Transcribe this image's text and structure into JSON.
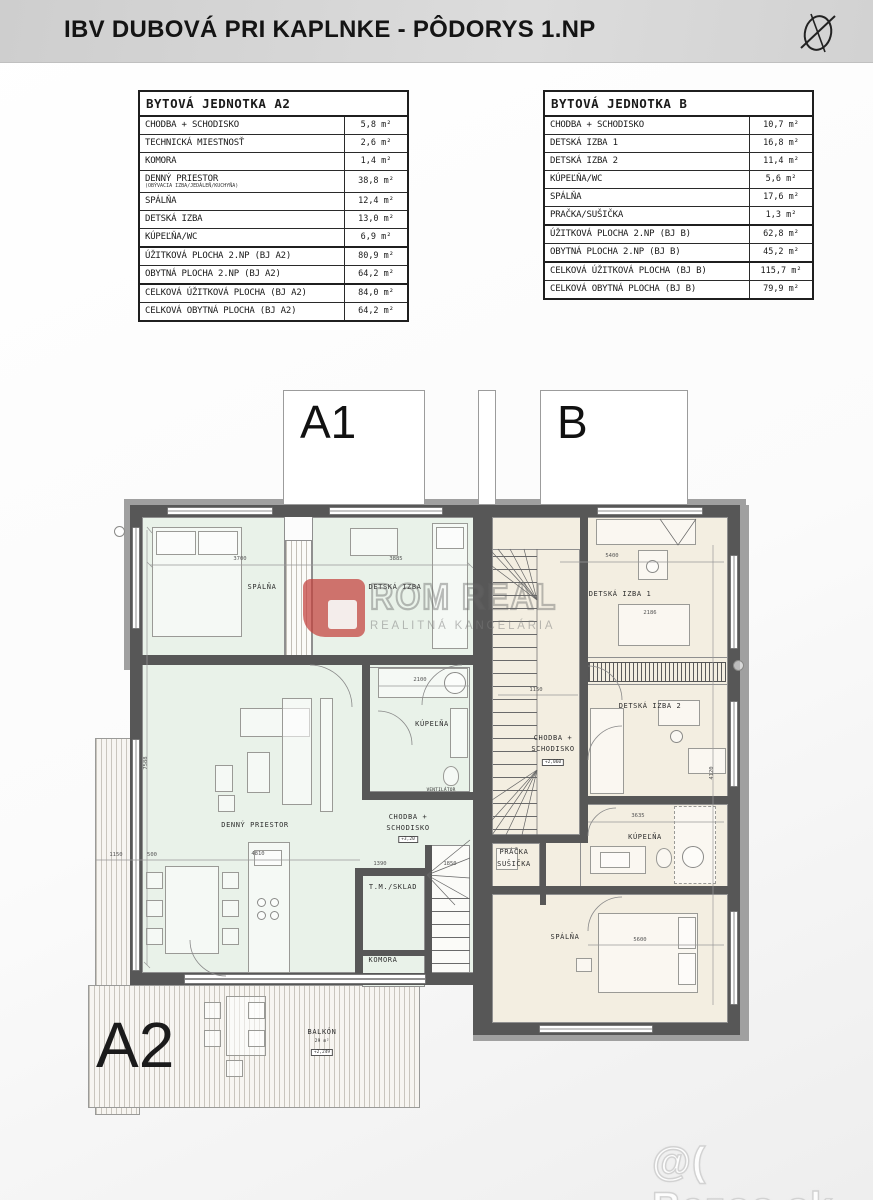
{
  "header": {
    "title": "IBV DUBOVÁ PRI KAPLNKE - PÔDORYS 1.NP",
    "compass_icon": "north-compass"
  },
  "tables": [
    {
      "id": "a2",
      "title": "BYTOVÁ JEDNOTKA A2",
      "rows": [
        {
          "label": "CHODBA + SCHODISKO",
          "value": "5,8 m²"
        },
        {
          "label": "TECHNICKÁ MIESTNOSŤ",
          "value": "2,6 m²"
        },
        {
          "label": "KOMORA",
          "value": "1,4 m²"
        },
        {
          "label": "DENNÝ PRIESTOR",
          "sub": "(OBÝVACIA IZBA/JEDÁLEŇ/KUCHYŇA)",
          "value": "38,8 m²"
        },
        {
          "label": "SPÁLŇA",
          "value": "12,4 m²"
        },
        {
          "label": "DETSKÁ IZBA",
          "value": "13,0 m²"
        },
        {
          "label": "KÚPEĽŇA/WC",
          "value": "6,9 m²"
        }
      ],
      "summary": [
        {
          "label": "ÚŽITKOVÁ PLOCHA 2.NP (BJ A2)",
          "value": "80,9 m²"
        },
        {
          "label": "OBYTNÁ PLOCHA 2.NP (BJ A2)",
          "value": "64,2 m²"
        },
        {
          "label": "CELKOVÁ ÚŽITKOVÁ PLOCHA (BJ A2)",
          "value": "84,0 m²"
        },
        {
          "label": "CELKOVÁ OBYTNÁ PLOCHA (BJ A2)",
          "value": "64,2 m²"
        }
      ]
    },
    {
      "id": "b",
      "title": "BYTOVÁ JEDNOTKA B",
      "rows": [
        {
          "label": "CHODBA + SCHODISKO",
          "value": "10,7 m²"
        },
        {
          "label": "DETSKÁ IZBA 1",
          "value": "16,8 m²"
        },
        {
          "label": "DETSKÁ IZBA 2",
          "value": "11,4 m²"
        },
        {
          "label": "KÚPEĽŇA/WC",
          "value": "5,6 m²"
        },
        {
          "label": "SPÁLŇA",
          "value": "17,6 m²"
        },
        {
          "label": "PRAČKA/SUŠIČKA",
          "value": "1,3 m²"
        }
      ],
      "summary": [
        {
          "label": "ÚŽITKOVÁ PLOCHA 2.NP (BJ B)",
          "value": "62,8 m²"
        },
        {
          "label": "OBYTNÁ PLOCHA 2.NP (BJ B)",
          "value": "45,2 m²"
        },
        {
          "label": "CELKOVÁ ÚŽITKOVÁ PLOCHA (BJ B)",
          "value": "115,7 m²"
        },
        {
          "label": "CELKOVÁ OBYTNÁ PLOCHA (BJ B)",
          "value": "79,9 m²"
        }
      ]
    }
  ],
  "plan": {
    "labels": {
      "unit_a1": "A1",
      "unit_b": "B",
      "unit_a2": "A2",
      "spalna_a": "SPÁLŇA",
      "detska_a": "DETSKÁ IZBA",
      "kupelna_a": "KÚPEĽŇA",
      "ventilator": "VENTILÁTOR",
      "denny": "DENNÝ PRIESTOR",
      "chodba_l1": "CHODBA +",
      "chodba_l2": "SCHODISKO",
      "tm_sklad": "T.M./SKLAD",
      "komora": "KOMORA",
      "detska_b1": "DETSKÁ IZBA 1",
      "detska_b2": "DETSKÁ IZBA 2",
      "pracka_l1": "PRÁČKA",
      "pracka_l2": "SUŠIČKA",
      "kupelna_b": "KÚPEĽŇA",
      "spalna_b": "SPÁLŇA",
      "balkon": "BALKÓN",
      "balkon_area": "29 m²",
      "level_a": "+3,20",
      "level_b": "+2,060",
      "level_balkon": "+2,249"
    },
    "dims": [
      {
        "t": "3700",
        "x": 240,
        "y": 556
      },
      {
        "t": "3885",
        "x": 396,
        "y": 556
      },
      {
        "t": "5400",
        "x": 612,
        "y": 553
      },
      {
        "t": "2100",
        "x": 420,
        "y": 677
      },
      {
        "t": "1150",
        "x": 116,
        "y": 852
      },
      {
        "t": "500",
        "x": 152,
        "y": 852
      },
      {
        "t": "4810",
        "x": 258,
        "y": 851
      },
      {
        "t": "1390",
        "x": 380,
        "y": 861
      },
      {
        "t": "1850",
        "x": 450,
        "y": 861
      },
      {
        "t": "1150",
        "x": 536,
        "y": 687
      },
      {
        "t": "3635",
        "x": 638,
        "y": 813
      },
      {
        "t": "5600",
        "x": 640,
        "y": 937
      },
      {
        "t": "2186",
        "x": 650,
        "y": 610
      },
      {
        "t": "7588",
        "x": 146,
        "y": 760,
        "v": true
      },
      {
        "t": "4120",
        "x": 712,
        "y": 770,
        "v": true
      }
    ]
  },
  "watermarks": {
    "agency_logo_letter": "P",
    "agency_text": "ROM REAL",
    "agency_sub": "REALITNÁ KANCELÁRIA",
    "site": "@( Bazos.sk"
  },
  "colors": {
    "accent_red": "#c4403c",
    "room_a_green": "#e9f2e9",
    "room_b_beige": "#f3eee1",
    "wall_gray": "#575757",
    "header_gray": "#d4d4d4"
  }
}
